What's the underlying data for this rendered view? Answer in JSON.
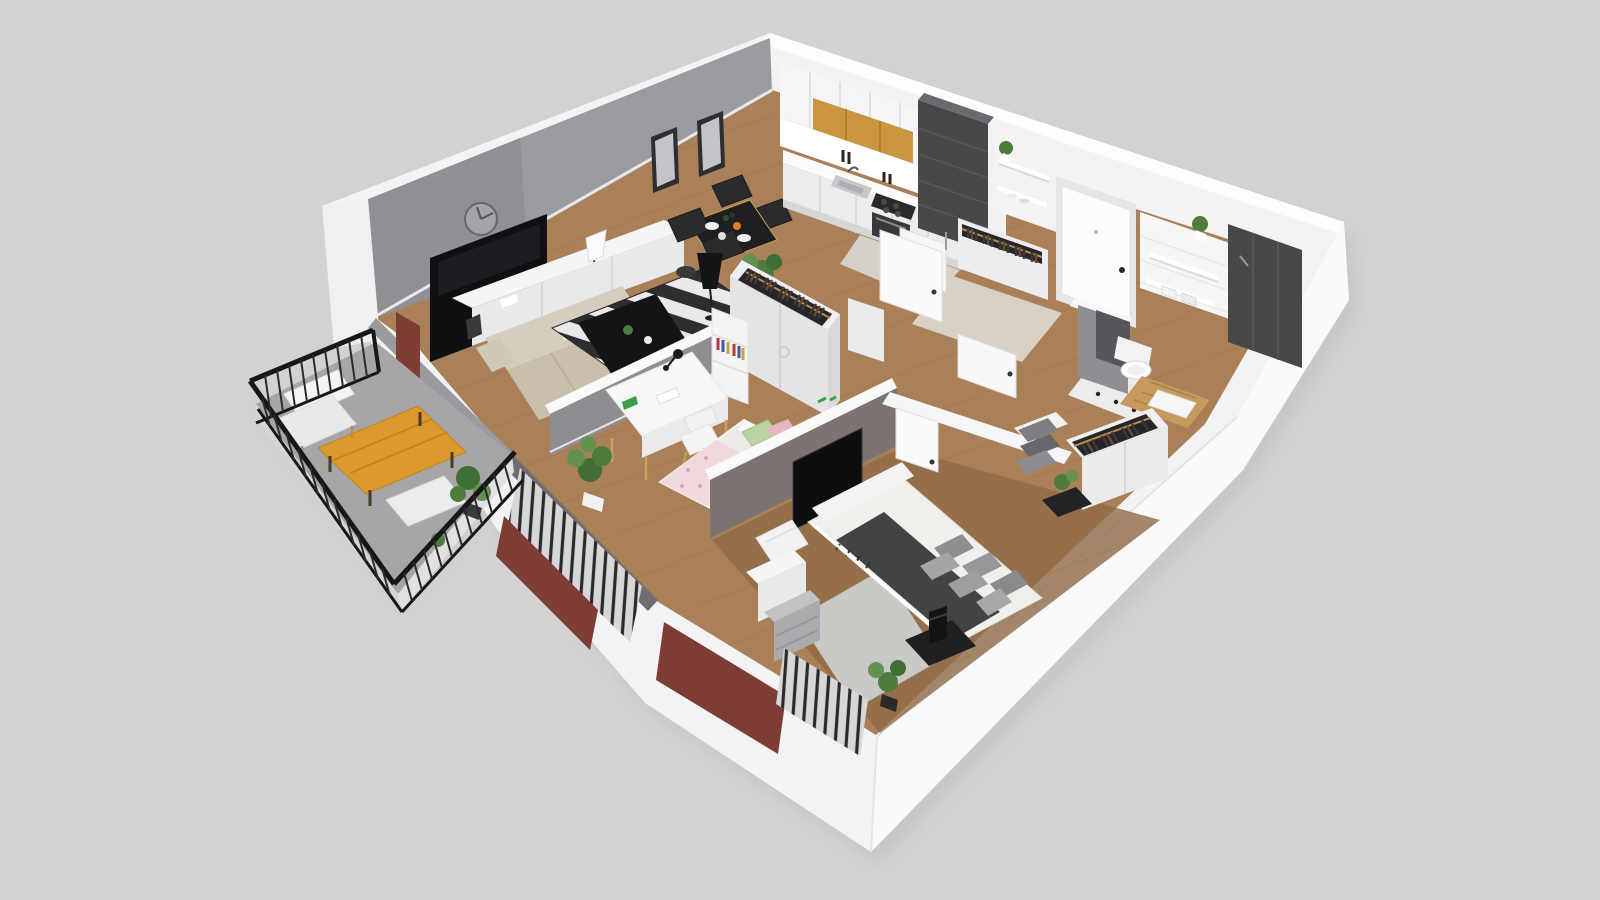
{
  "meta": {
    "title": "3D cutaway floor plan render of a two-bedroom apartment with balcony",
    "view": "dollhouse perspective from above"
  },
  "colors": {
    "bg": "#d2d2d4",
    "shadow": "#bfbfc3",
    "slab": "#f3f3f5",
    "ext_face": "#fafafb",
    "wall_top": "#fdfdfe",
    "accent_wall": "#9a9a9f",
    "partition": "#8e8e92",
    "partition_dark": "#6e6e72",
    "brown_wall": "#7b7470",
    "wood_floor": "#aa8058",
    "wood_line": "#8f6a42",
    "hall_tile": "#d8d2c6",
    "bath_floor": "#ececea",
    "oak": "#c9953f",
    "dark_tile": "#47474a",
    "red_wall": "#7d3c34",
    "railing_black": "#17171a",
    "balcony_floor": "#a6a6a9",
    "balcony_table": "#dd9a2c",
    "sofa": "#cfc8b6",
    "rug_dark": "#2e2e30",
    "rug_light": "#e9e9e7",
    "bed_linen": "#f0efec",
    "pillow_gray": "#8e8e91",
    "throw": "#434346",
    "bed_rug": "#c9c9c6",
    "kid_pink": "#e4b6c2",
    "kid_green": "#b9d3a2",
    "kid_blanket": "#efd9dd",
    "plant_green": "#4e7c3c",
    "plant_light": "#639151",
    "plant_dark": "#3f6f34",
    "white_furniture": "#f4f4f5",
    "white_face": "#e9e9ec",
    "clothes_rail": "#b98c4a"
  },
  "rooms": [
    {
      "name": "living-room",
      "furniture": [
        "wall-clock",
        "picture-frames",
        "wall-tv",
        "media-console",
        "table-lamp",
        "corner-sofa",
        "striped-rug",
        "coffee-table",
        "dining-table",
        "dining-chairs",
        "floor-lamp",
        "basket",
        "potted-palm"
      ]
    },
    {
      "name": "kitchen",
      "furniture": [
        "upper-cabinets",
        "oak-cabinets",
        "backsplash",
        "countertop",
        "sink",
        "cooktop",
        "oven",
        "tall-tiled-column",
        "open-shelves",
        "shelf-plant",
        "boiler-cabinet"
      ]
    },
    {
      "name": "hallway",
      "furniture": [
        "entrance-door",
        "open-wardrobe-with-clothes",
        "open-door-leaves",
        "wall-stub"
      ]
    },
    {
      "name": "bathroom",
      "furniture": [
        "tiled-wall",
        "wall-shelves",
        "towels",
        "shelf-plant",
        "dark-shower-panel",
        "wall-hung-toilet",
        "wooden-bath-mat",
        "toiletry-caddy"
      ]
    },
    {
      "name": "kids-room",
      "furniture": [
        "desk",
        "desk-lamp",
        "toy-dinosaur",
        "papers",
        "desk-chair",
        "single-bed",
        "green-pillow",
        "pink-pillow",
        "floral-blanket",
        "bookshelf",
        "open-closet-with-clothes",
        "monstera-plant",
        "window-blinds"
      ]
    },
    {
      "name": "bedroom",
      "furniture": [
        "double-bed",
        "upholstered-bench",
        "gray-pillows",
        "dark-throw",
        "area-rug",
        "nightstand",
        "black-table-lamp",
        "white-armchair",
        "vanity-desk",
        "gray-dresser",
        "open-wardrobe-with-clothes",
        "storage-boxes",
        "wall-tv-niche",
        "potted-plants",
        "window-blinds"
      ]
    },
    {
      "name": "balcony",
      "furniture": [
        "metal-railing",
        "wooden-coffee-table",
        "cushioned-chair",
        "bench-seat",
        "potted-plants"
      ]
    }
  ]
}
